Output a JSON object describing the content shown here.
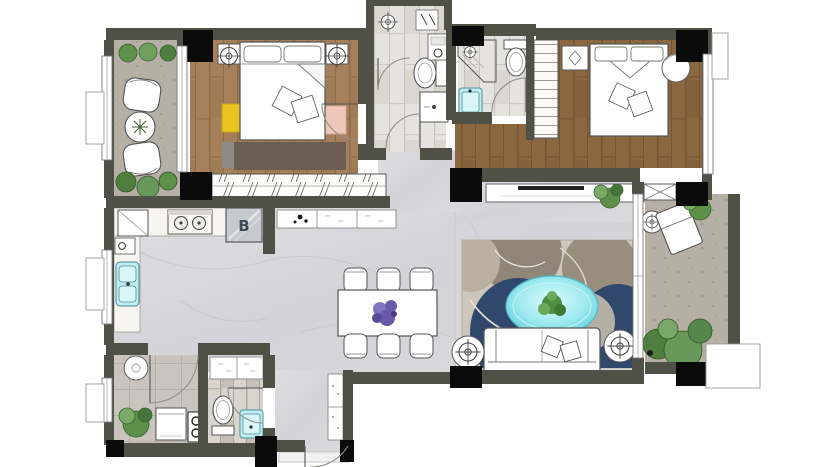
{
  "title": "apartment-floor-plan",
  "labels": {
    "kitchen_cabinet": "B"
  },
  "palette": {
    "wall": "#4f5046",
    "column": "#0b0b0b",
    "wood_light": "#a5805a",
    "wood_dark": "#8b673f",
    "marble": "#d8d8db",
    "concrete": "#b6afa6",
    "bath_tile": "#e5e3df",
    "laundry_tile": "#c9c4be",
    "accent_cyan": "#7fdde6",
    "accent_navy": "#2f4468",
    "accent_yellow": "#e9c322",
    "accent_pink": "#eec6ba",
    "plant_green": "#5d9049",
    "flower_purple": "#7b68b5",
    "rug_base": "#cdc6ba"
  },
  "rooms": [
    {
      "name": "balcony-top-left",
      "floor": "concrete",
      "furniture": [
        "armchair",
        "armchair",
        "round-table",
        "planters"
      ]
    },
    {
      "name": "bedroom-1",
      "floor": "wood",
      "furniture": [
        "double-bed",
        "nightstand",
        "nightstand",
        "ceiling-light",
        "ceiling-light",
        "yellow-stool",
        "pink-bench",
        "rug",
        "sliding-wardrobe"
      ]
    },
    {
      "name": "bathroom-1",
      "floor": "tile",
      "furniture": [
        "shower-room",
        "toilet",
        "vanity",
        "water-heater"
      ]
    },
    {
      "name": "bathroom-2",
      "floor": "tile",
      "furniture": [
        "corner-shower",
        "toilet",
        "washbasin"
      ]
    },
    {
      "name": "bedroom-2",
      "floor": "wood",
      "furniture": [
        "double-bed",
        "nightstand",
        "round-lamp-table",
        "shelved-closet"
      ]
    },
    {
      "name": "kitchen",
      "floor": "marble",
      "furniture": [
        "fridge",
        "cooktop",
        "cabinet-B",
        "double-sink"
      ]
    },
    {
      "name": "dining-area",
      "floor": "marble",
      "furniture": [
        "dining-table",
        "chair",
        "chair",
        "chair",
        "chair",
        "chair",
        "chair",
        "flower-centerpiece",
        "sideboard"
      ]
    },
    {
      "name": "living-room",
      "floor": "marble",
      "furniture": [
        "area-rug",
        "oval-coffee-table",
        "sofa",
        "cushions",
        "side-table",
        "side-table",
        "tv-console",
        "plant"
      ]
    },
    {
      "name": "laundry-room",
      "floor": "tile",
      "furniture": [
        "basin",
        "washing-machine",
        "meter-box",
        "plant"
      ]
    },
    {
      "name": "bathroom-3",
      "floor": "tile",
      "furniture": [
        "toilet",
        "washbasin",
        "cabinets"
      ]
    },
    {
      "name": "entry-vestibule",
      "floor": "marble",
      "furniture": [
        "shoe-cabinet",
        "entry-door"
      ]
    },
    {
      "name": "balcony-right",
      "floor": "concrete",
      "furniture": [
        "lounge-chair",
        "side-table",
        "planter-box",
        "plants",
        "ac-platform"
      ]
    }
  ]
}
